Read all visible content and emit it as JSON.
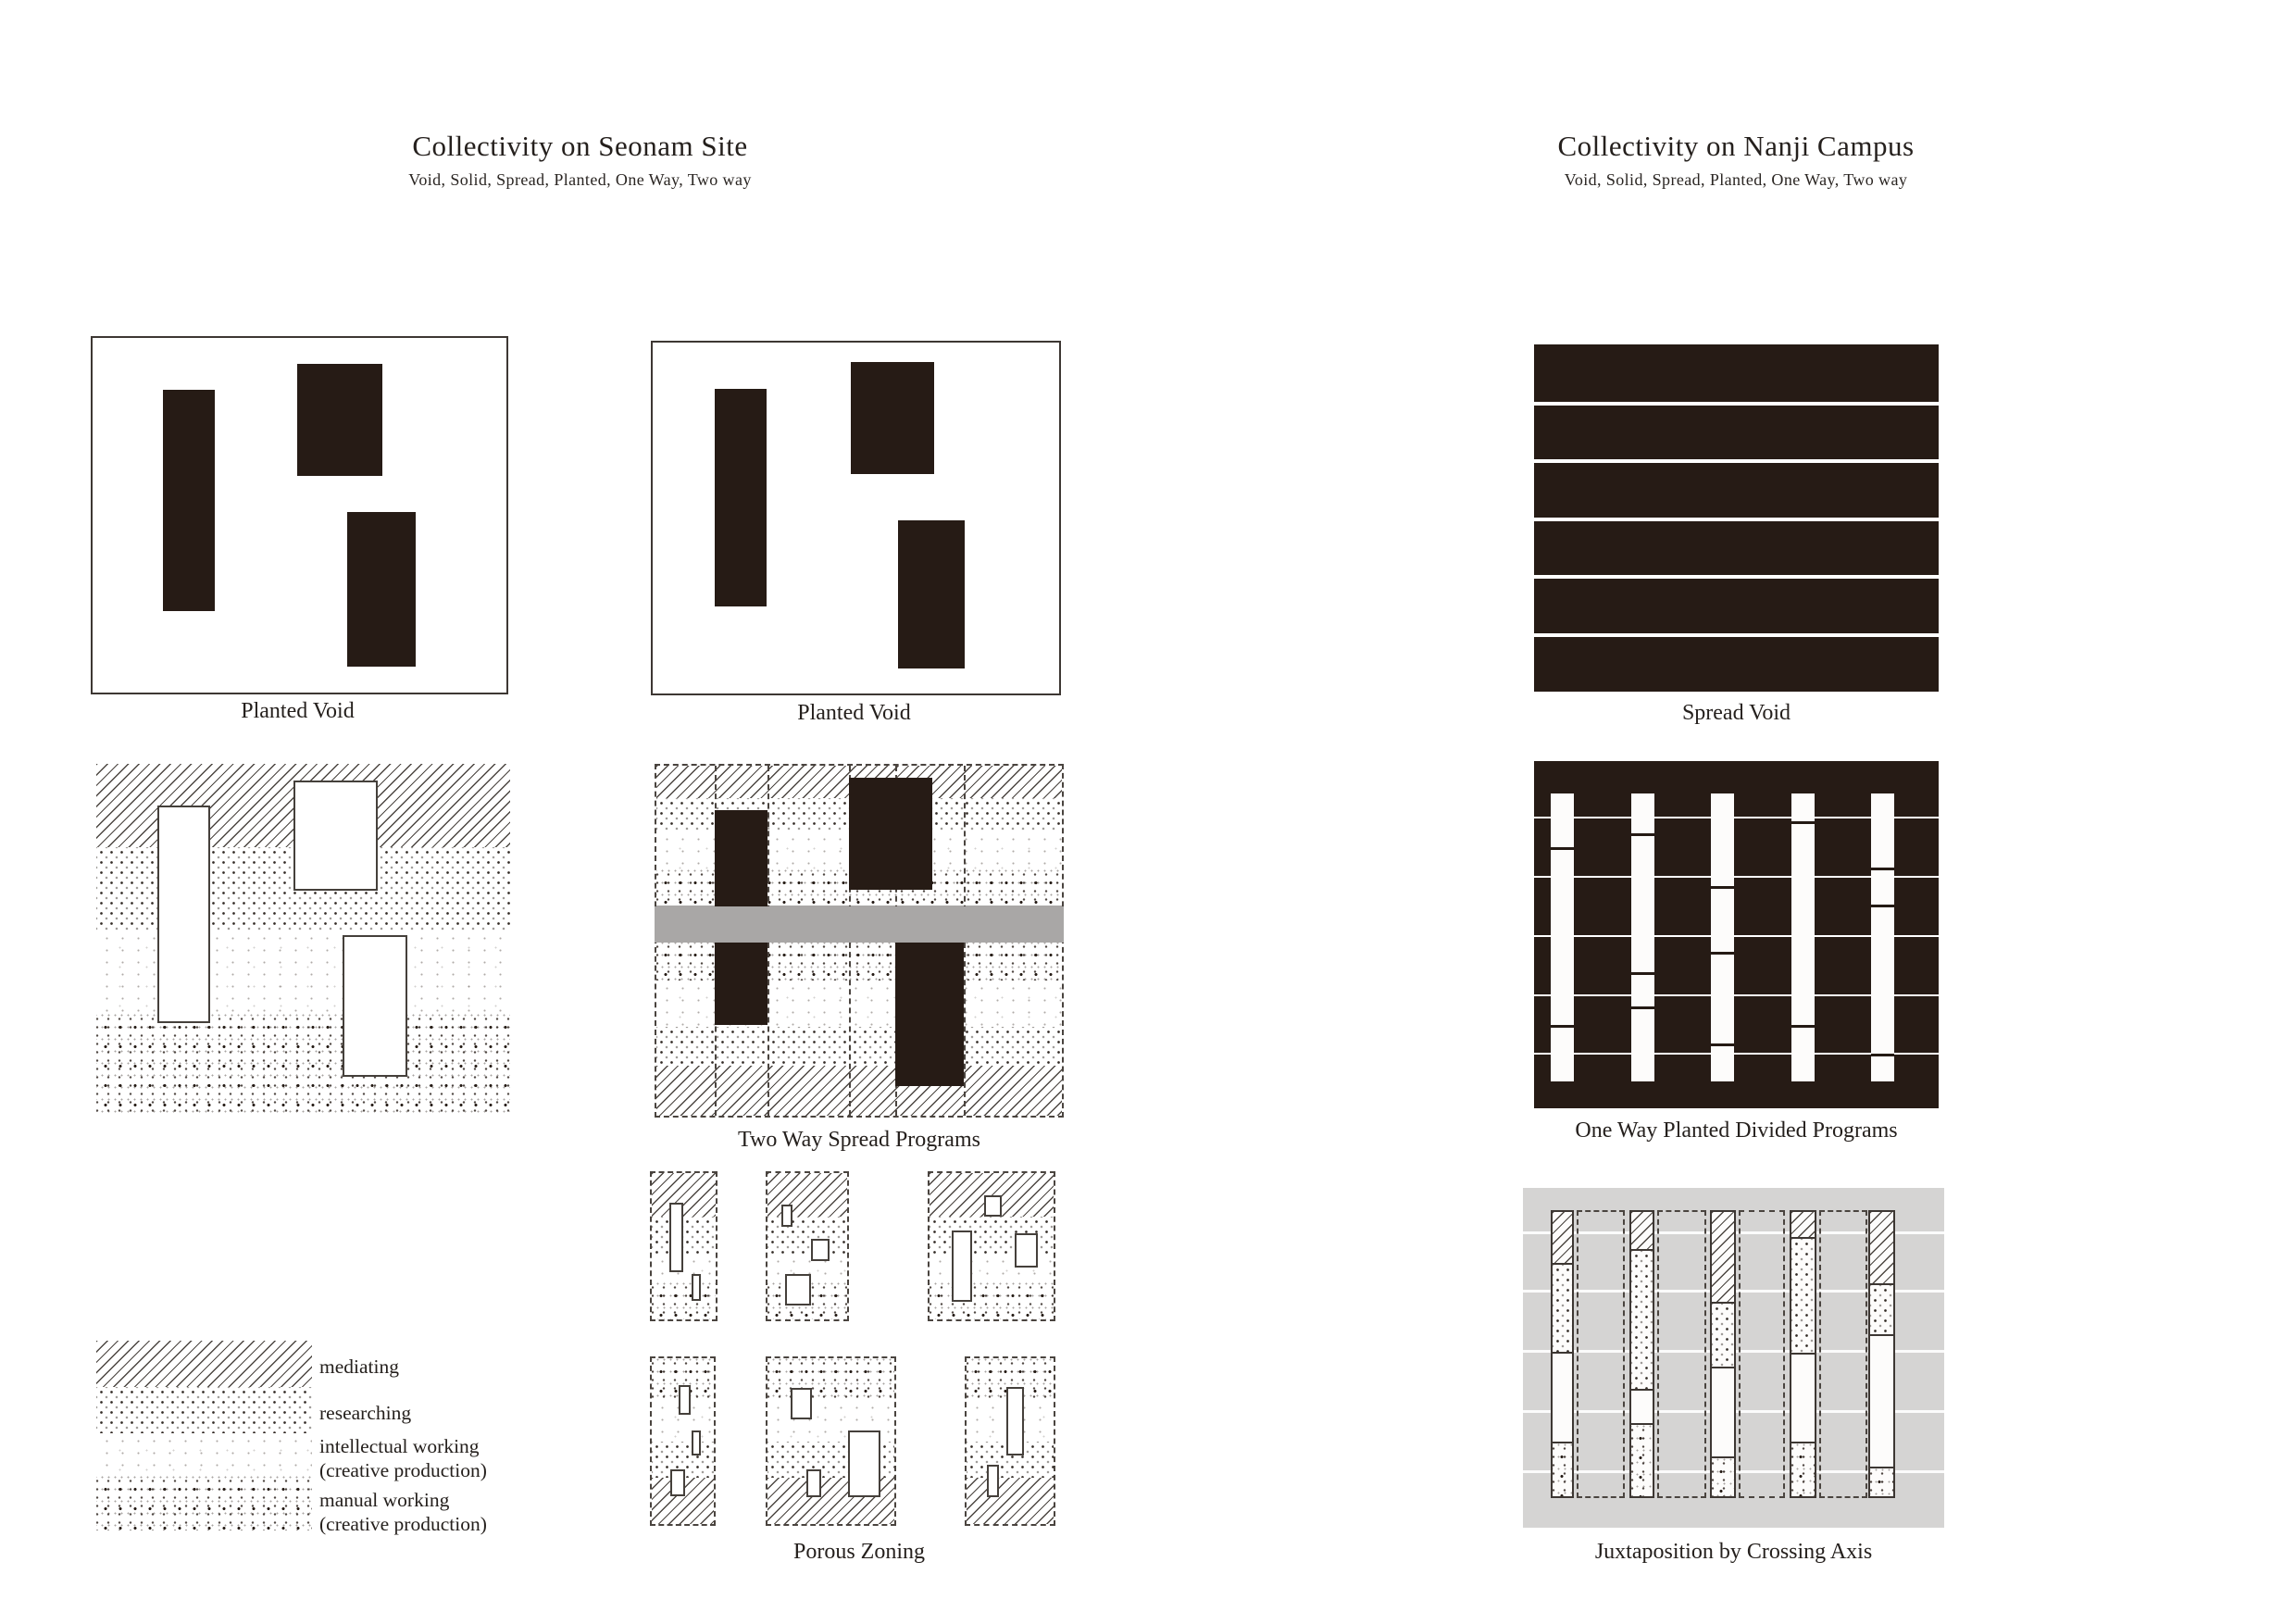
{
  "page": {
    "left": {
      "title": "Collectivity on Seonam Site",
      "subtitle": "Void, Solid, Spread, Planted, One Way, Two way"
    },
    "right": {
      "title": "Collectivity on Nanji Campus",
      "subtitle": "Void, Solid, Spread, Planted, One Way, Two way"
    }
  },
  "panels": {
    "planted_void_left": {
      "caption": "Planted Void"
    },
    "planted_void_mid": {
      "caption": "Planted Void"
    },
    "spread_void": {
      "caption": "Spread Void"
    },
    "two_way_spread": {
      "caption": "Two Way Spread Programs"
    },
    "one_way_planted": {
      "caption": "One Way Planted Divided Programs"
    },
    "porous_zoning": {
      "caption": "Porous Zoning"
    },
    "juxtaposition": {
      "caption": "Juxtaposition by Crossing Axis"
    }
  },
  "legend": {
    "items": [
      {
        "texture": "diagonal-hatch",
        "label": "mediating",
        "sublabel": ""
      },
      {
        "texture": "diagonal-dots",
        "label": "researching",
        "sublabel": ""
      },
      {
        "texture": "fine-speckle",
        "label": "intellectual working",
        "sublabel": "(creative production)"
      },
      {
        "texture": "coarse-speckle",
        "label": "manual working",
        "sublabel": "(creative production)"
      }
    ]
  },
  "colors": {
    "ink": "#261b15",
    "band_gray": "#a9a7a6",
    "panel_gray": "#d5d4d3",
    "paper": "#ffffff"
  }
}
